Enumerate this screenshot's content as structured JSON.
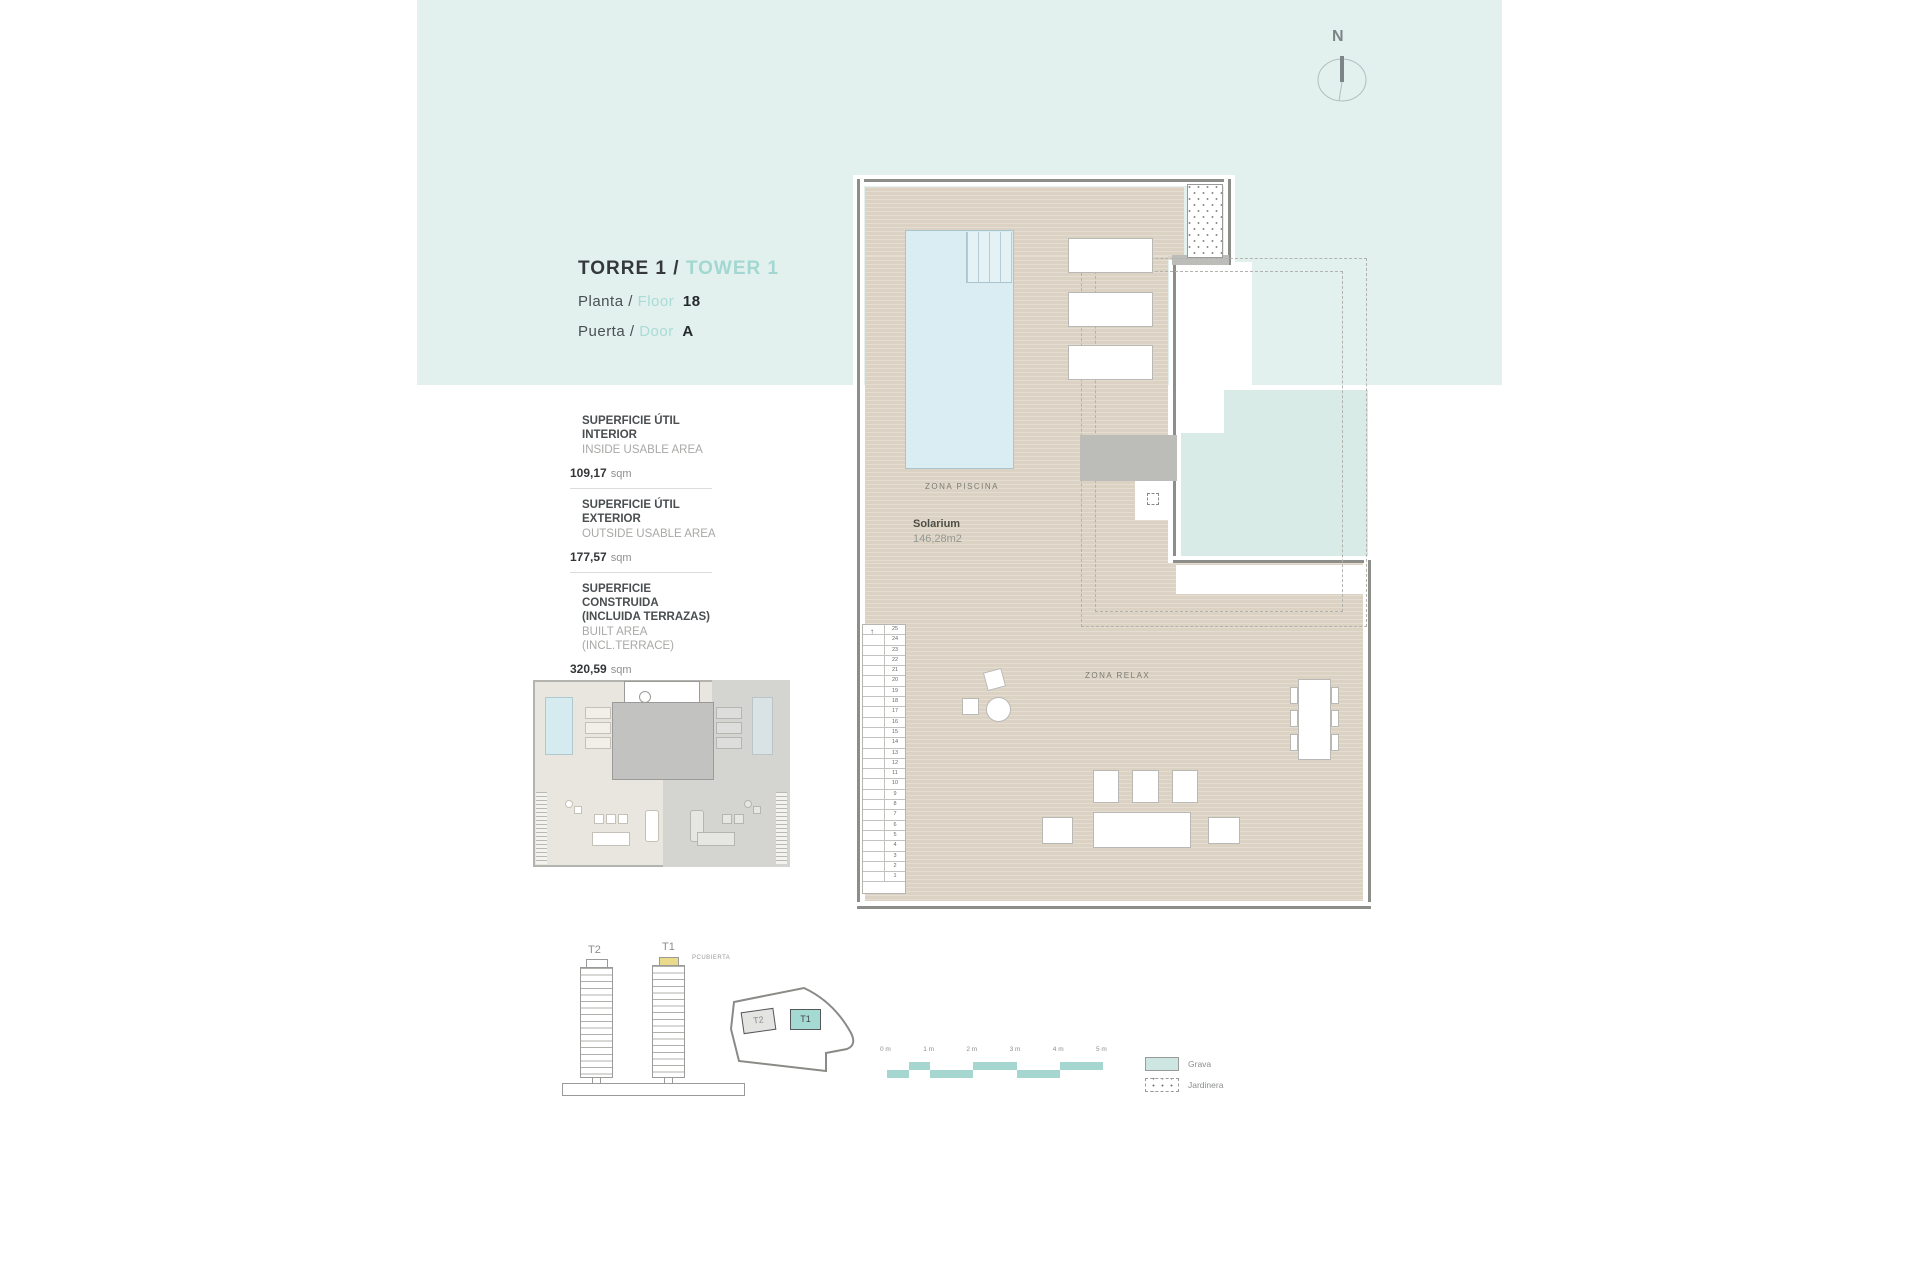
{
  "colors": {
    "band": "#e2f0ee",
    "accent_teal": "#a3d8d2",
    "grava": "#d9ebe7",
    "t1_highlight": "#a5dad3",
    "roof_yellow": "#e9da8c"
  },
  "compass": {
    "label": "N"
  },
  "title": {
    "torre": "TORRE 1",
    "sep": "/",
    "tower": "TOWER 1",
    "rows": [
      {
        "es": "Planta",
        "sep": "/",
        "en": "Floor",
        "value": "18"
      },
      {
        "es": "Puerta",
        "sep": "/",
        "en": "Door",
        "value": "A"
      }
    ]
  },
  "areas": [
    {
      "label_es": "SUPERFICIE ÚTIL INTERIOR",
      "label_es2": "",
      "label_en": "INSIDE USABLE AREA",
      "value": "109,17",
      "unit": "sqm"
    },
    {
      "label_es": "SUPERFICIE ÚTIL EXTERIOR",
      "label_es2": "",
      "label_en": "OUTSIDE USABLE AREA",
      "value": "177,57",
      "unit": "sqm"
    },
    {
      "label_es": "SUPERFICIE CONSTRUIDA",
      "label_es2": "(INCLUIDA TERRAZAS)",
      "label_en": "BUILT AREA (INCL.TERRACE)",
      "value": "320,59",
      "unit": "sqm"
    }
  ],
  "plan": {
    "zona_piscina": "ZONA PISCINA",
    "solarium": "Solarium",
    "solarium_area": "146,28m2",
    "zona_relax": "ZONA RELAX",
    "stairs": {
      "numbers": [
        25,
        24,
        23,
        22,
        21,
        20,
        19,
        18,
        17,
        16,
        15,
        14,
        13,
        12,
        11,
        10,
        9,
        8,
        7,
        6,
        5,
        4,
        3,
        2,
        1
      ]
    }
  },
  "towers": {
    "t2": {
      "label": "T2"
    },
    "t1": {
      "label": "T1",
      "roof_label": "PCUBIERTA"
    }
  },
  "siteplan": {
    "t2_label": "T2",
    "t1_label": "T1"
  },
  "scalebar": {
    "labels": [
      "0 m",
      "1 m",
      "2 m",
      "3 m",
      "4 m",
      "5 m"
    ],
    "px_per_m": 43.2,
    "color": "#a5d6cf",
    "segments": [
      {
        "start": 0,
        "end": 0.5,
        "row": "low"
      },
      {
        "start": 0.5,
        "end": 1,
        "row": "high"
      },
      {
        "start": 1,
        "end": 2,
        "row": "low"
      },
      {
        "start": 2,
        "end": 3,
        "row": "high"
      },
      {
        "start": 3,
        "end": 4,
        "row": "low"
      },
      {
        "start": 4,
        "end": 5,
        "row": "high"
      }
    ]
  },
  "legend": {
    "items": [
      {
        "label": "Grava",
        "swatch": "fill"
      },
      {
        "label": "Jardinera",
        "swatch": "dashed-dots"
      }
    ]
  }
}
